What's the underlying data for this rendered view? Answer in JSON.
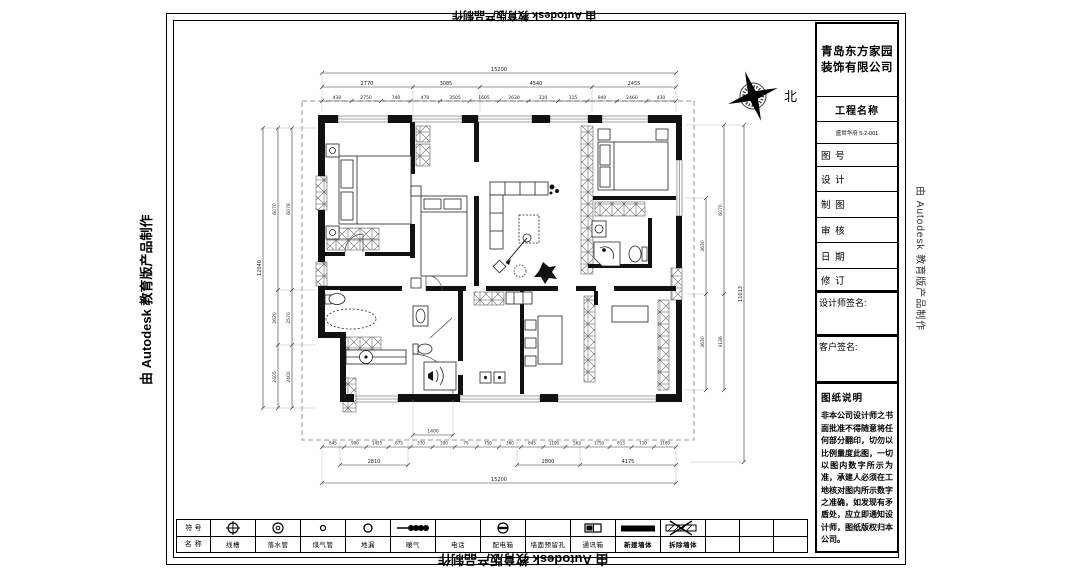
{
  "watermarks": {
    "autodesk": "由 Autodesk 教育版产品制作"
  },
  "compass": {
    "north_label": "北"
  },
  "title_block": {
    "company_line1": "青岛东方家园",
    "company_line2": "装饰有限公司",
    "project_label": "工程名称",
    "project_name": "盛世华府 5-2-001",
    "fields": [
      "图 号",
      "设 计",
      "制 图",
      "审 核",
      "日 期",
      "修 订"
    ],
    "designer_signature_label": "设计师签名:",
    "client_signature_label": "客户签名:",
    "notes_title": "图纸说明",
    "notes_body": "非本公司设计师之书面批准不得随意将任何部分翻印，切勿以比例量度此图，一切以图内数字所示为准，承建人必须在工地核对图内所示数字之准确，如发现有矛盾处，应立即通知设计师，图纸版权归本公司。"
  },
  "legend": {
    "symbol_row_label": "符 号",
    "name_row_label": "名 称",
    "items": [
      {
        "symbol": "crosshair-circle",
        "name": "线槽"
      },
      {
        "symbol": "circle-ring",
        "name": "落水管"
      },
      {
        "symbol": "small-circle",
        "name": "煤气管"
      },
      {
        "symbol": "circle",
        "name": "地漏"
      },
      {
        "symbol": "radiator-coil",
        "name": "暖气"
      },
      {
        "symbol": "none",
        "name": "电话"
      },
      {
        "symbol": "circle-bar",
        "name": "配电箱"
      },
      {
        "symbol": "none",
        "name": "墙面预留孔"
      },
      {
        "symbol": "comm-box",
        "name": "通讯箱"
      },
      {
        "symbol": "solid-bar",
        "name": "新建墙体"
      },
      {
        "symbol": "hatch-x-bar",
        "name": "拆除墙体"
      }
    ]
  },
  "plan": {
    "dims": {
      "top_total": "15200",
      "top_mid": [
        "2770",
        "3085",
        "4540",
        "2455"
      ],
      "top_detail": [
        "430",
        "2750",
        "740",
        "470",
        "3505",
        "1605",
        "2630",
        "310",
        "115",
        "940",
        "2460",
        "430"
      ],
      "left_total": "12040",
      "left_chain_a": [
        "6070",
        "2620",
        "2405"
      ],
      "left_chain_b": [
        "6078",
        "2570",
        "2400"
      ],
      "right_chain_a": [
        "3630",
        "3630"
      ],
      "right_chain_b": [
        "6070",
        "3136"
      ],
      "right_total": "11013",
      "bottom_inner": "1400",
      "bottom_detail": [
        "845",
        "900",
        "1455",
        "875",
        "370",
        "300",
        "70",
        "750",
        "360",
        "845",
        "1190",
        "563",
        "1750",
        "813",
        "710",
        "1180"
      ],
      "bottom_mid": [
        "2810",
        "2800",
        "4175"
      ],
      "bottom_total": "15200"
    }
  }
}
